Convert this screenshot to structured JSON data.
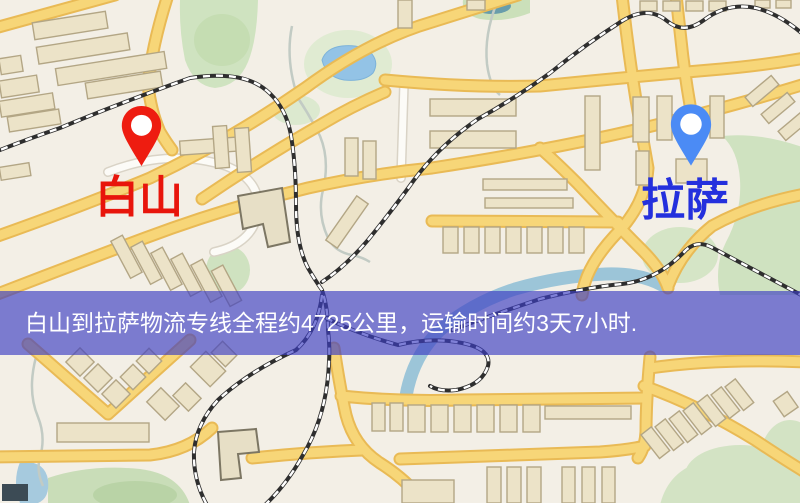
{
  "map": {
    "origin_marker": {
      "label": "白山",
      "label_color": "#e8150b",
      "pin_color": "#ee1c10"
    },
    "destination_marker": {
      "label": "拉萨",
      "label_color": "#2430dd",
      "pin_color": "#4b8bf5"
    }
  },
  "banner": {
    "text": "白山到拉萨物流专线全程约4725公里，运输时间约3天7小时.",
    "background_color": "#3c3ec2",
    "text_color": "#ffffff"
  },
  "route": {
    "origin_city": "白山",
    "destination_city": "拉萨",
    "distance_text": "约4725公里",
    "duration_text": "约3天7小时"
  },
  "map_palette": {
    "background": "#f3efe6",
    "road_primary": "#f7d678",
    "road_casing": "#e9ba55",
    "road_minor": "#fcfbf7",
    "railway": "#2e2e2e",
    "building_fill": "#ece3c8",
    "building_stroke": "#b3a685",
    "park_green": "#d3e4c4",
    "water_blue": "#9ac8e8"
  }
}
